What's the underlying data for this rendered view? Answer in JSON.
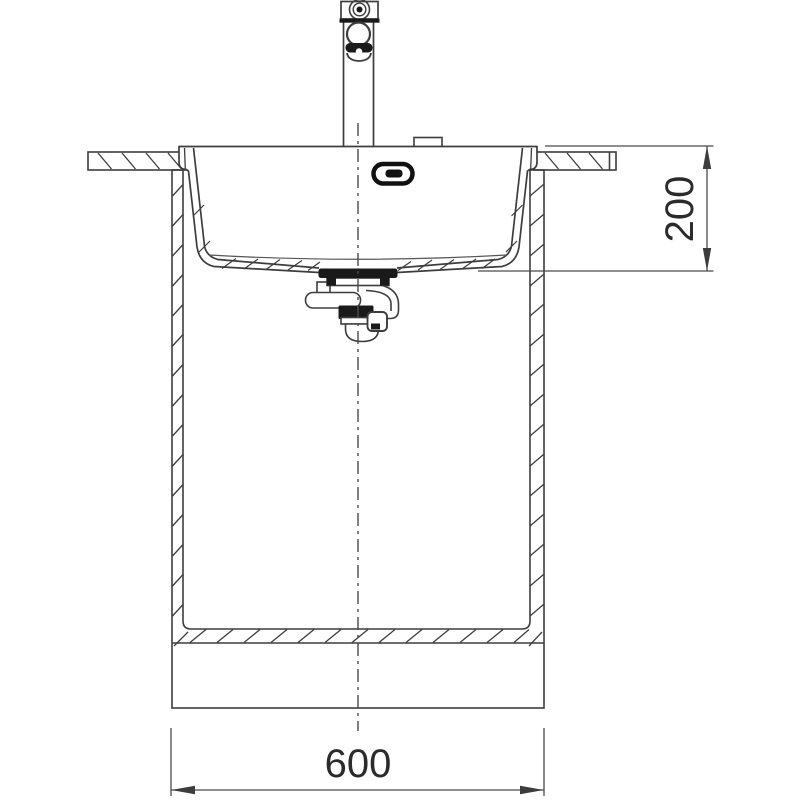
{
  "drawing": {
    "type": "technical-line-drawing",
    "subject": "sink-front-sectional-view",
    "colors": {
      "background": "#ffffff",
      "line": "#3d3d3d",
      "dark_fill": "#1a1a1a",
      "dimension": "#4a4a4a",
      "text": "#2b2b2b"
    },
    "components": [
      "mixer-tap",
      "tap-hole-cover",
      "sink-basin",
      "overflow-slot",
      "worktop-section",
      "base-cabinet-section",
      "drain-trap-assembly",
      "centerline"
    ],
    "dimensions": {
      "cabinet_width": {
        "label": "600",
        "orientation": "horizontal"
      },
      "bowl_depth": {
        "label": "200",
        "orientation": "vertical"
      }
    }
  }
}
